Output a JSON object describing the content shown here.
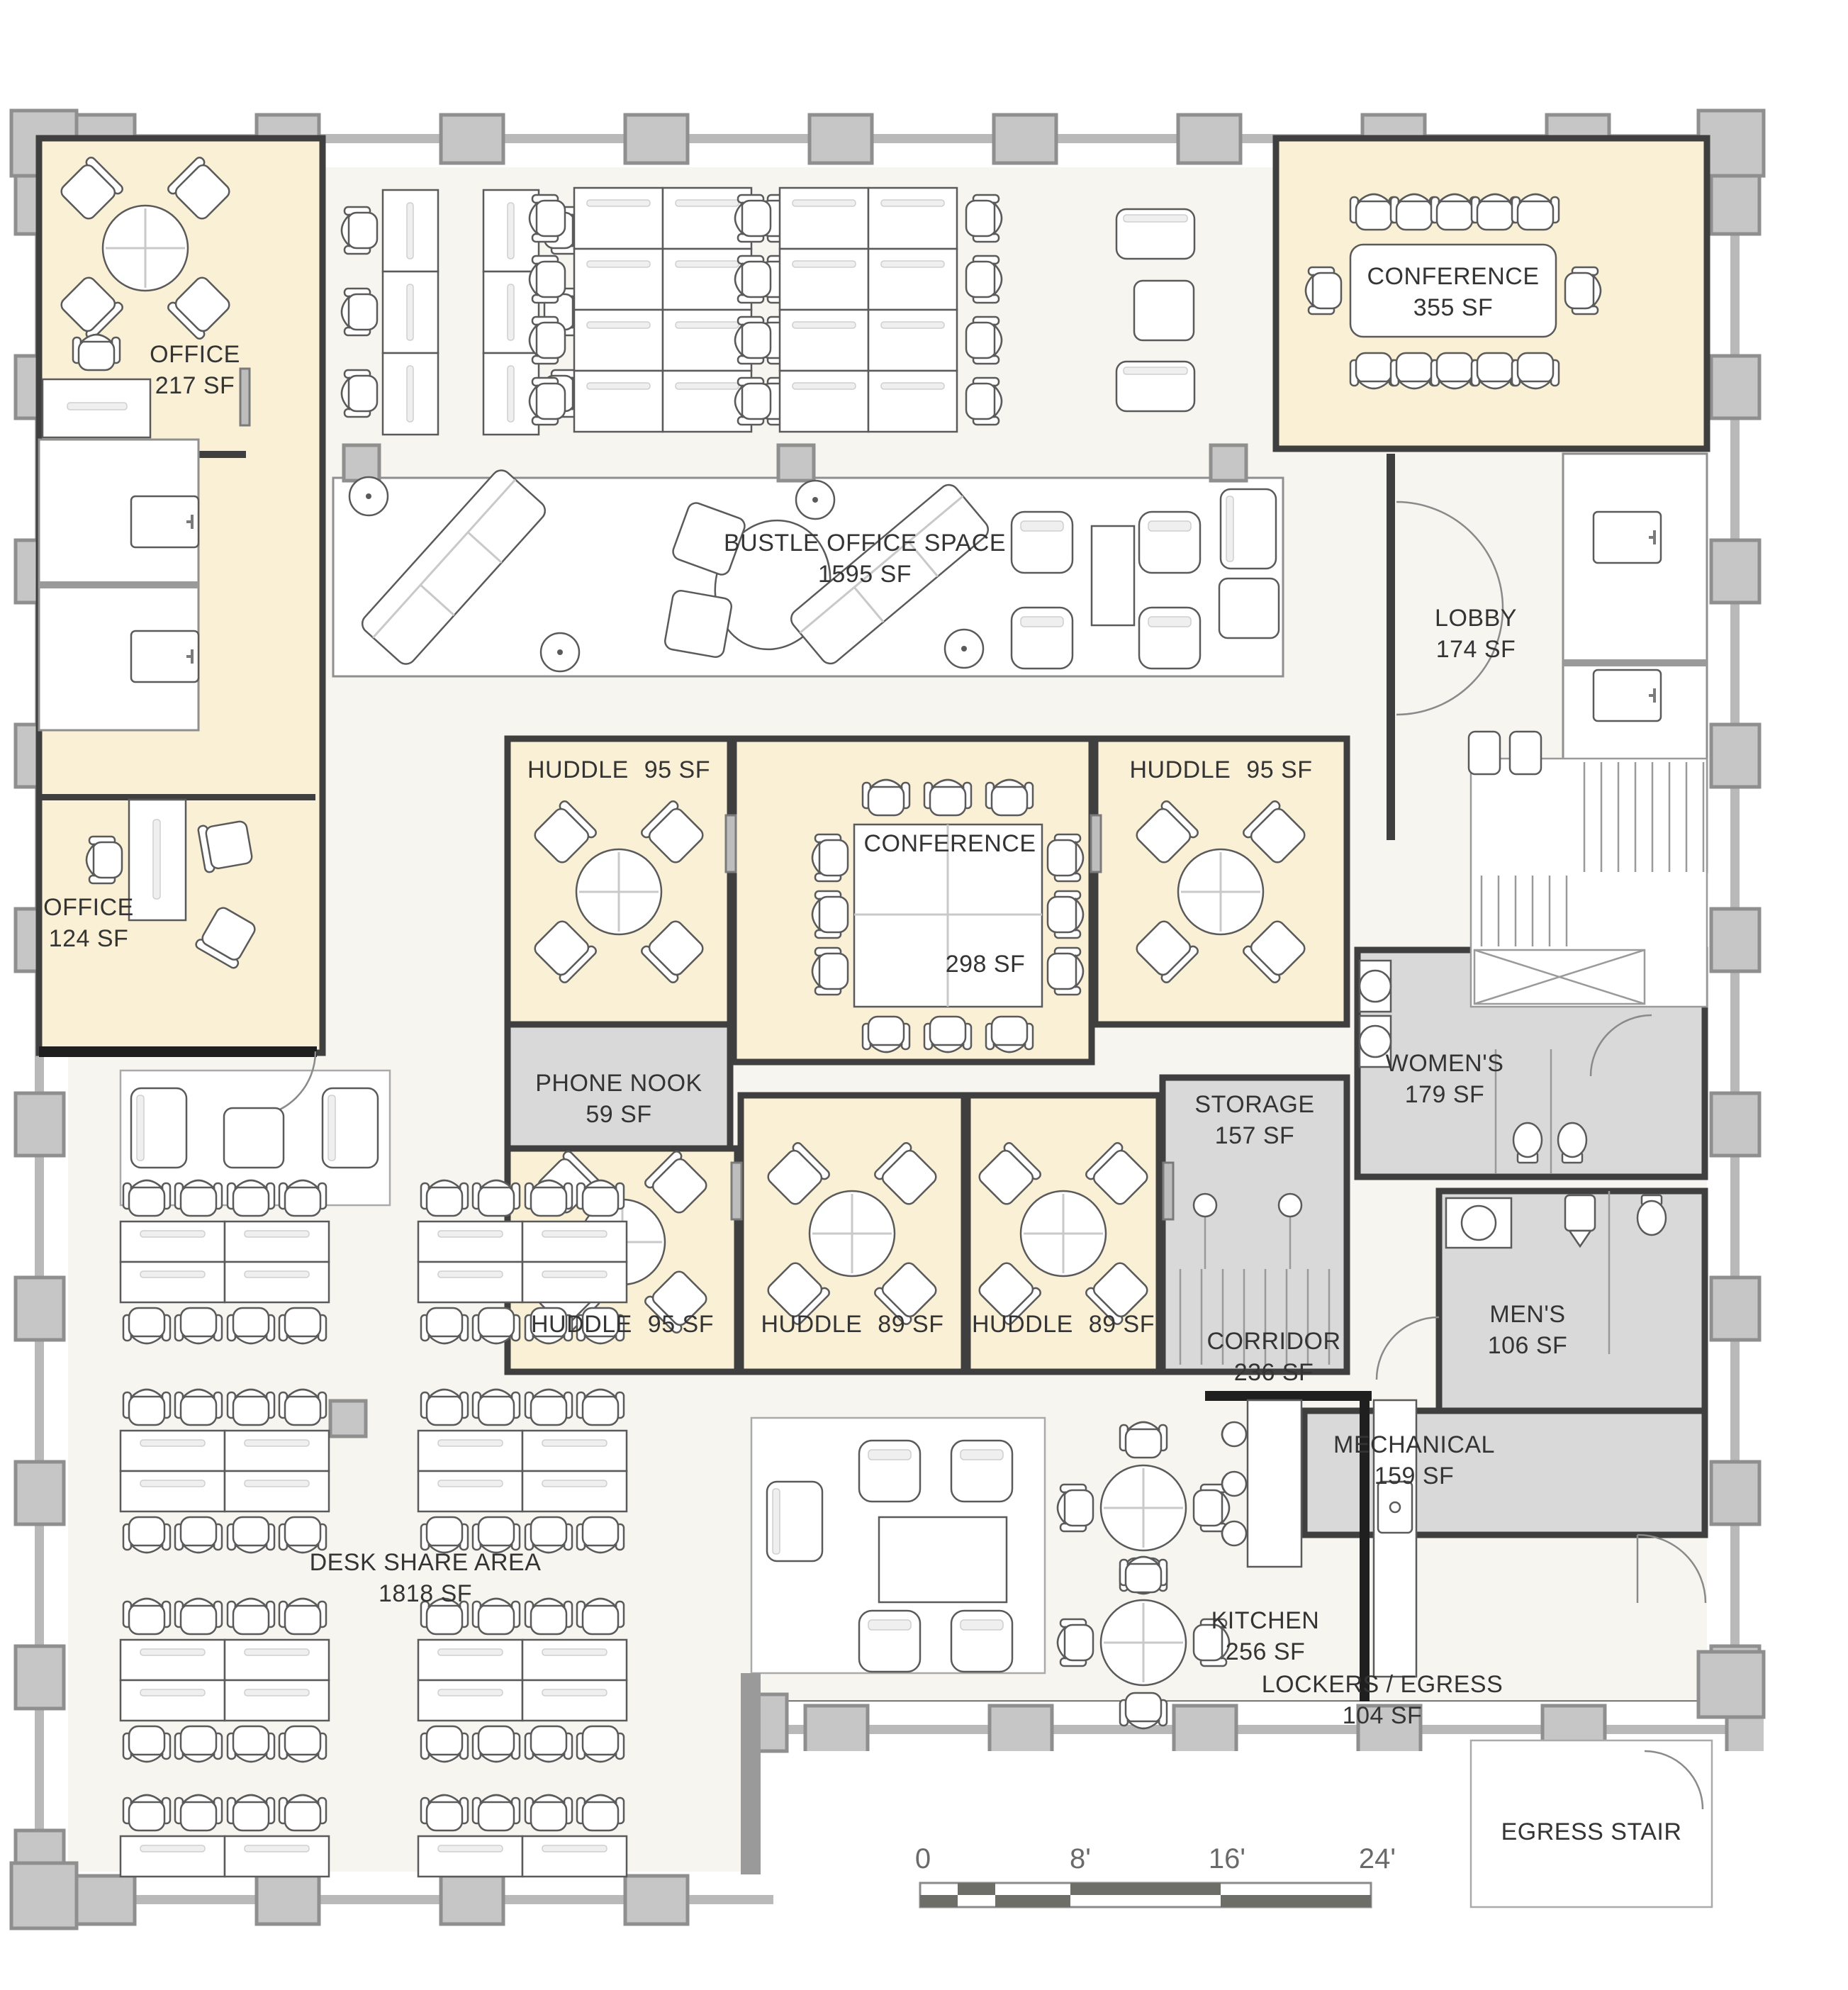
{
  "plan": {
    "type": "office floor plan"
  },
  "rooms": {
    "office217": {
      "name": "OFFICE",
      "area": "217 SF"
    },
    "conference355": {
      "name": "CONFERENCE",
      "area": "355 SF"
    },
    "bustle": {
      "name": "BUSTLE OFFICE SPACE",
      "area": "1595 SF"
    },
    "lobby": {
      "name": "LOBBY",
      "area": "174 SF"
    },
    "huddleTopLeft": {
      "name": "HUDDLE",
      "area": "95 SF"
    },
    "huddleTopRight": {
      "name": "HUDDLE",
      "area": "95 SF"
    },
    "conference298": {
      "name": "CONFERENCE",
      "area": "298 SF"
    },
    "phoneNook": {
      "name": "PHONE NOOK",
      "area": "59 SF"
    },
    "office124": {
      "name": "OFFICE",
      "area": "124 SF"
    },
    "huddleBottom1": {
      "name": "HUDDLE",
      "area": "95 SF"
    },
    "huddleBottom2": {
      "name": "HUDDLE",
      "area": "89 SF"
    },
    "huddleBottom3": {
      "name": "HUDDLE",
      "area": "89 SF"
    },
    "storage": {
      "name": "STORAGE",
      "area": "157 SF"
    },
    "womens": {
      "name": "WOMEN'S",
      "area": "179 SF"
    },
    "corridor": {
      "name": "CORRIDOR",
      "area": "236 SF"
    },
    "mens": {
      "name": "MEN'S",
      "area": "106 SF"
    },
    "mechanical": {
      "name": "MECHANICAL",
      "area": "159 SF"
    },
    "deskShare": {
      "name": "DESK SHARE AREA",
      "area": "1818 SF"
    },
    "kitchen": {
      "name": "KITCHEN",
      "area": "256 SF"
    },
    "lockers": {
      "name": "LOCKERS / EGRESS",
      "area": "104 SF"
    },
    "egressStair": {
      "name": "EGRESS STAIR",
      "area": ""
    }
  },
  "scale_bar": {
    "ticks": [
      "0",
      "8'",
      "16'",
      "24'"
    ]
  },
  "colors": {
    "cream": "#faf0d6",
    "room_gray": "#d9d9d9",
    "floor": "#f7f5f0",
    "wall": "#3f3f3f",
    "column": "#c6c6c6"
  }
}
